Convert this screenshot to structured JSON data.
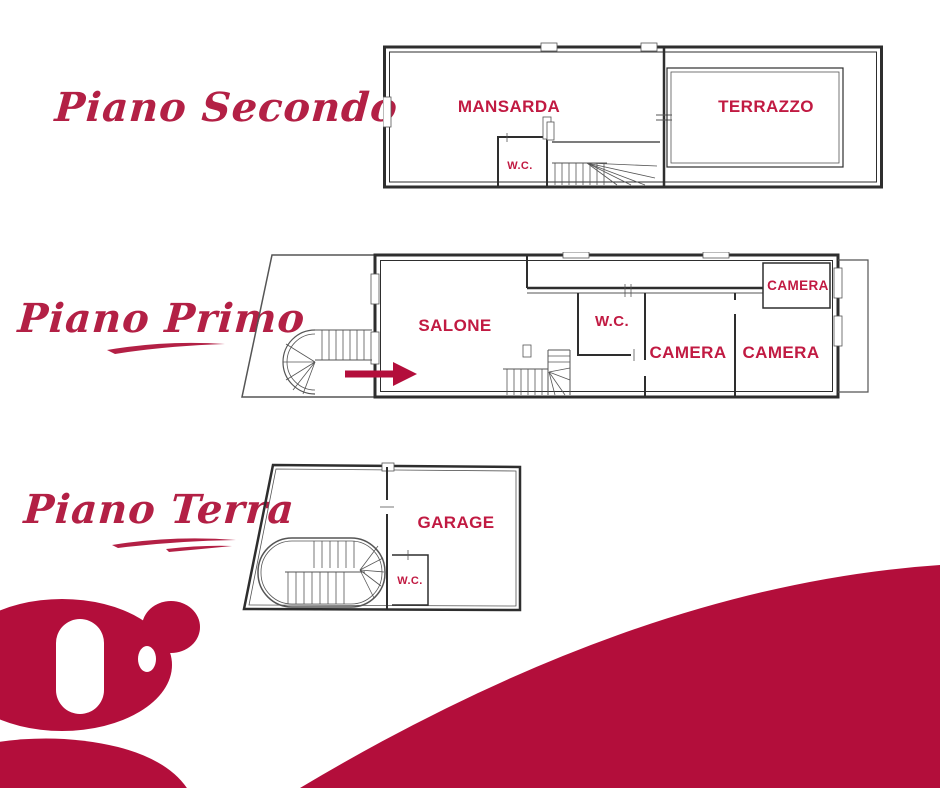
{
  "colors": {
    "script_text": "#b32045",
    "room_label": "#c11a42",
    "brand_shape": "#b30e3b",
    "wall_line": "#2e2e2e"
  },
  "icons": {
    "entrance_arrow": "right-arrow",
    "logo_letter_glyph": "serif-g"
  },
  "floors": [
    {
      "title": "Piano Secondo",
      "rooms": {
        "mansarda": "MANSARDA",
        "terrazzo": "TERRAZZO",
        "wc": "W.C."
      }
    },
    {
      "title": "Piano Primo",
      "rooms": {
        "salone": "SALONE",
        "wc": "W.C.",
        "camera_top": "CAMERA",
        "camera_mid": "CAMERA",
        "camera_right": "CAMERA"
      }
    },
    {
      "title": "Piano Terra",
      "rooms": {
        "garage": "GARAGE",
        "wc": "W.C."
      }
    }
  ],
  "logo_letter": "g"
}
